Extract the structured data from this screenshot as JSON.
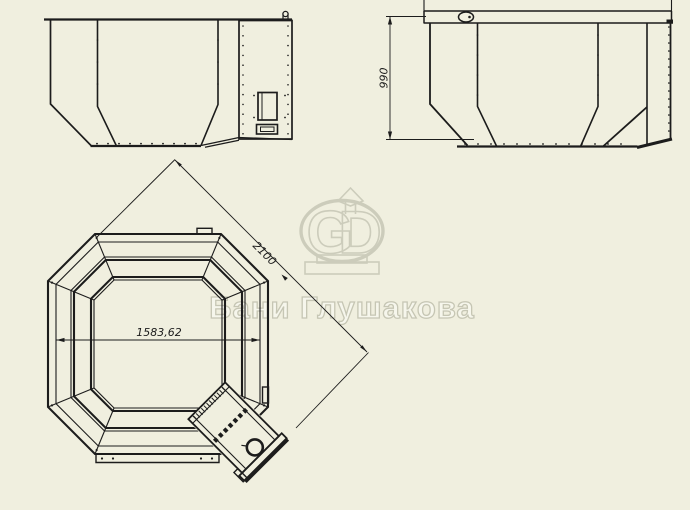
{
  "drawing": {
    "background_color": "#f0efdf",
    "line_color": "#1c1c1c",
    "watermark_color": "#c9c9b8"
  },
  "watermark": {
    "letter_g": "G",
    "letter_d": "D",
    "brand_text": "Бани Глушакова"
  },
  "views": {
    "side_elevation": {
      "height_dimension": "990"
    },
    "plan": {
      "inner_width_dimension": "1583,62",
      "diagonal_dimension": "2100"
    }
  }
}
